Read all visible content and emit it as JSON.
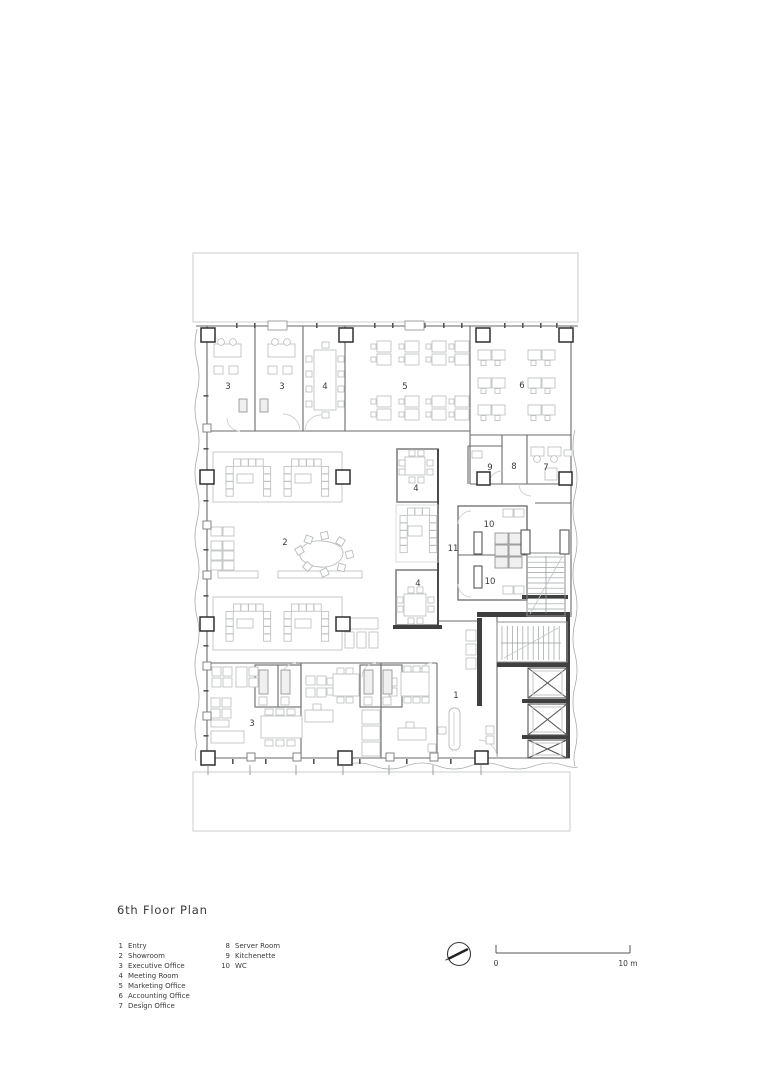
{
  "title": "6th Floor Plan",
  "legend": {
    "column1": [
      {
        "num": "1",
        "label": "Entry"
      },
      {
        "num": "2",
        "label": "Showroom"
      },
      {
        "num": "3",
        "label": "Executive Office"
      },
      {
        "num": "4",
        "label": "Meeting Room"
      },
      {
        "num": "5",
        "label": "Marketing Office"
      },
      {
        "num": "6",
        "label": "Accounting Office"
      },
      {
        "num": "7",
        "label": "Design Office"
      }
    ],
    "column2": [
      {
        "num": "8",
        "label": "Server Room"
      },
      {
        "num": "9",
        "label": "Kitchenette"
      },
      {
        "num": "10",
        "label": "WC"
      }
    ]
  },
  "scale_bar": {
    "start_label": "0",
    "end_label": "10 m"
  },
  "icons": {
    "north_arrow": "north-arrow-icon"
  },
  "plan": {
    "room_labels": [
      {
        "number": "3",
        "x": 228,
        "y": 389
      },
      {
        "number": "3",
        "x": 282,
        "y": 389
      },
      {
        "number": "4",
        "x": 325,
        "y": 389
      },
      {
        "number": "5",
        "x": 405,
        "y": 389
      },
      {
        "number": "6",
        "x": 522,
        "y": 388
      },
      {
        "number": "9",
        "x": 490,
        "y": 470
      },
      {
        "number": "8",
        "x": 514,
        "y": 469
      },
      {
        "number": "7",
        "x": 546,
        "y": 470
      },
      {
        "number": "4",
        "x": 416,
        "y": 491
      },
      {
        "number": "2",
        "x": 285,
        "y": 545
      },
      {
        "number": "11",
        "x": 453,
        "y": 551
      },
      {
        "number": "10",
        "x": 489,
        "y": 527
      },
      {
        "number": "10",
        "x": 490,
        "y": 584
      },
      {
        "number": "4",
        "x": 418,
        "y": 586
      },
      {
        "number": "3",
        "x": 252,
        "y": 726
      },
      {
        "number": "1",
        "x": 456,
        "y": 698
      }
    ]
  },
  "colors": {
    "wall": "#6a6a6a",
    "heavy_wall": "#3f3f3f",
    "furniture": "#b9bcbc",
    "context": "#c6c9c9",
    "label": "#3a3a3a"
  }
}
